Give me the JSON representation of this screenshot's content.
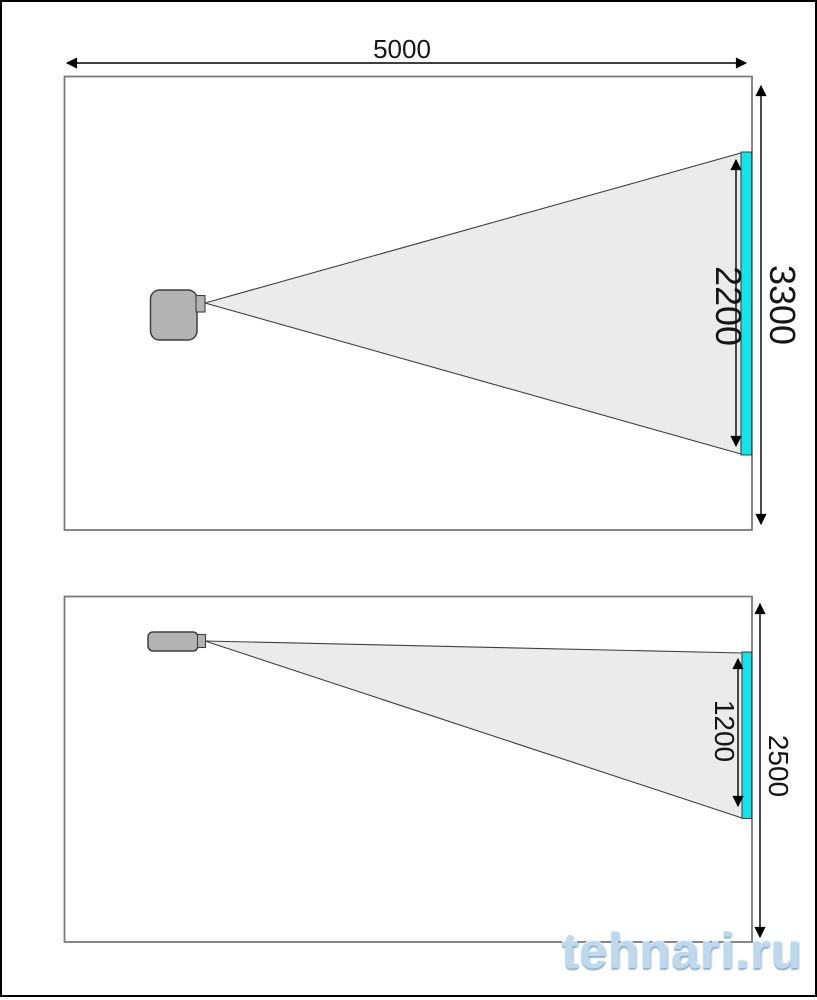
{
  "top_view": {
    "room_length_label": "5000",
    "room_width_label": "3300",
    "image_width_label": "2200"
  },
  "side_view": {
    "room_height_label": "2500",
    "image_height_label": "1200"
  },
  "watermark": {
    "text": "tehnari.ru"
  },
  "colors": {
    "screen": "#12e5ea",
    "beam_fill": "#ebebeb",
    "projector_fill": "#b3b3b3",
    "room_stroke": "#7a7a7a",
    "dimension_line": "#000000",
    "watermark_blue": "#bcd9f0"
  }
}
